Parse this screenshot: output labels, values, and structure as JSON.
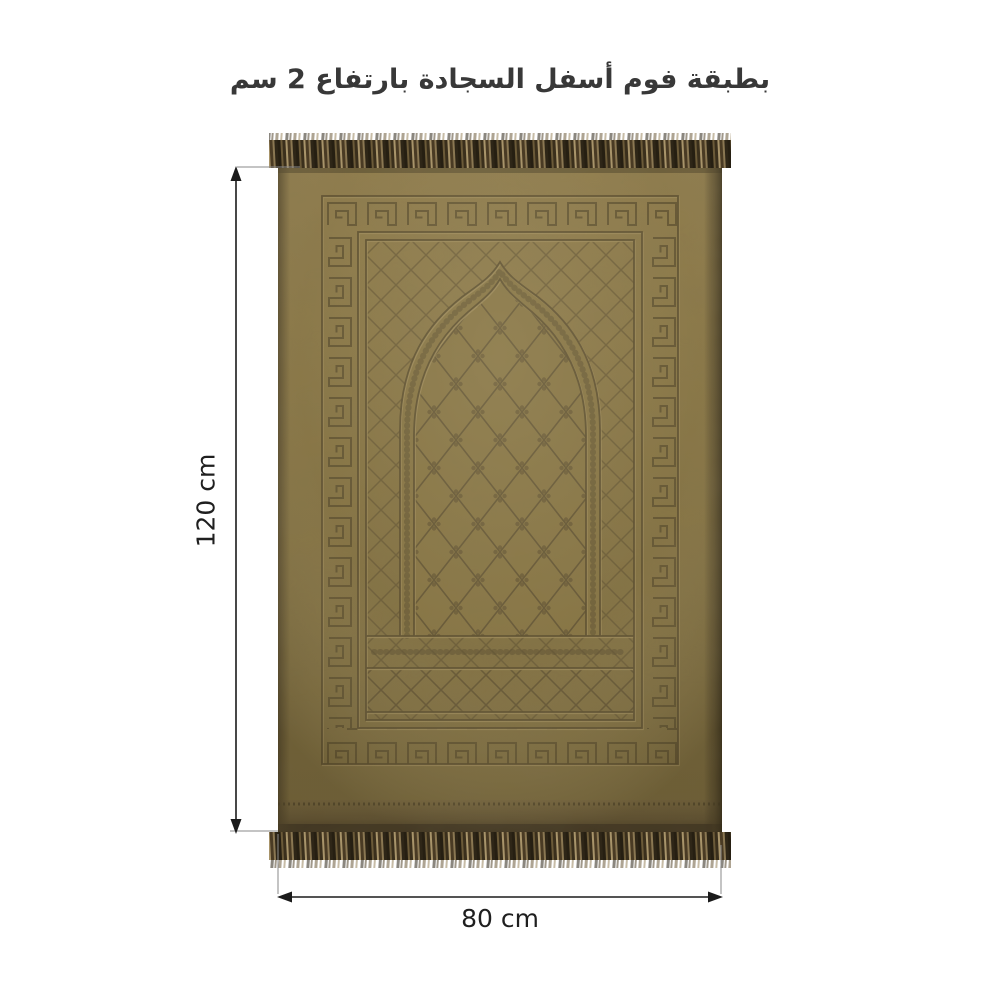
{
  "title": "بطبقة فوم أسفل السجادة بارتفاع 2 سم",
  "measurements": {
    "height": {
      "label": "120 cm"
    },
    "width": {
      "label": "80 cm"
    }
  },
  "product": {
    "item": "embossed velvet prayer rug with fringe",
    "pattern_motifs": [
      "greek-key-border",
      "diamond-lattice",
      "mihrab-arch",
      "quatrefoil-lattice",
      "scroll-band"
    ],
    "colors": {
      "rug_base": "#84713F",
      "rug_light": "#8D7947",
      "rug_shadow": "#6E5D37",
      "emboss_dark": "#564828",
      "emboss_light": "#9E8A58",
      "hem_band": "#5F5030",
      "edge_dark": "#4C3F25",
      "fringe_dark": "#2B2314",
      "fringe_mid": "#53432A",
      "fringe_light": "#A8946A",
      "annotation_line": "#1B1B1B",
      "extension_line": "#8A8A8A",
      "background": "#FFFFFF"
    }
  }
}
